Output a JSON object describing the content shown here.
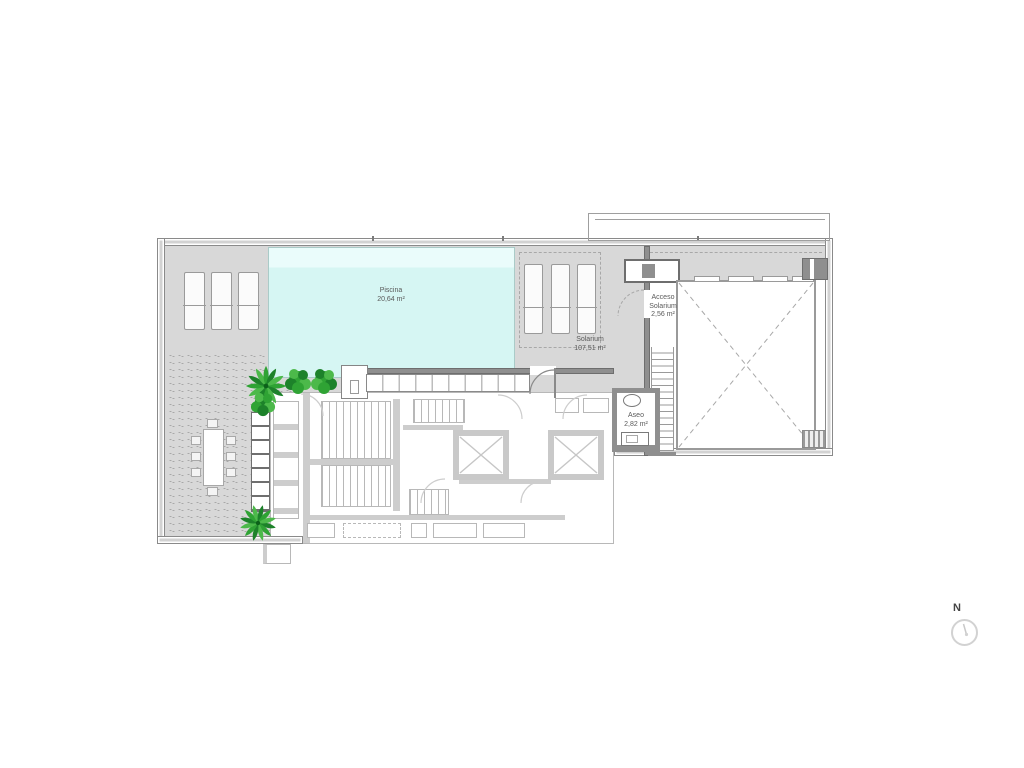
{
  "plan": {
    "rooms": {
      "piscina": {
        "name": "Piscina",
        "area": "20,64 m²"
      },
      "solarium": {
        "name": "Solarium",
        "area": "107,51 m²"
      },
      "acceso_solarium": {
        "line1": "Acceso",
        "line2": "Solarium",
        "area": "2,56 m²"
      },
      "aseo": {
        "name": "Aseo",
        "area": "2,82 m²"
      }
    },
    "north_label": "N"
  },
  "colors": {
    "terrace": "#d8d8d8",
    "pool": "#d6f6f3",
    "pool-light": "#eafcfb",
    "wall-fill": "#d2d2d2",
    "wall-edge": "#8a8a8a",
    "wall-dark": "#8f8f8f",
    "ghost": "#cdcdcd",
    "ghost-line": "#b8b8b8",
    "dash": "#a8a8a8",
    "green": "#2fa334",
    "green-dark": "#1d822a",
    "green-light": "#4cb94a",
    "text": "#5a5a5a"
  }
}
